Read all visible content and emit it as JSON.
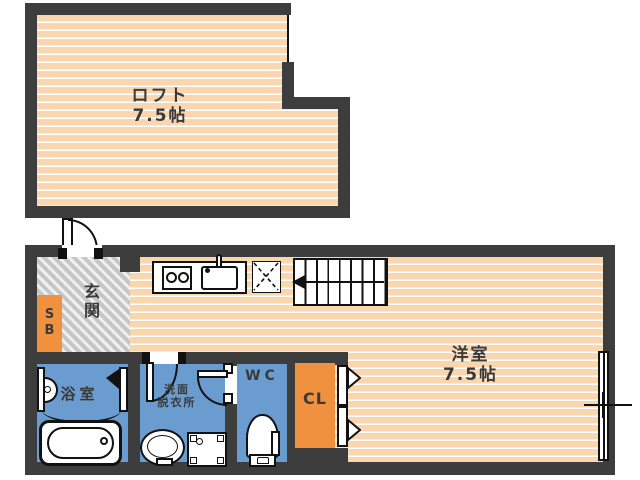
{
  "theme": {
    "wall": "#3d3d3d",
    "tatami": "#f9d6ae",
    "blue": "#6b9ccf",
    "orange": "#f0913f",
    "line": "#111111",
    "label": "#3a3a3a"
  },
  "rooms": {
    "loft": {
      "name": "ロフト",
      "size": "7.5帖"
    },
    "western": {
      "name": "洋室",
      "size": "7.5帖"
    },
    "entrance": {
      "name": "玄関"
    },
    "shoe_box": {
      "name": "SB"
    },
    "bath": {
      "name": "浴室"
    },
    "washroom": {
      "name_line1": "洗面",
      "name_line2": "脱衣所"
    },
    "wc": {
      "name": "WC"
    },
    "closet": {
      "name": "CL"
    }
  }
}
